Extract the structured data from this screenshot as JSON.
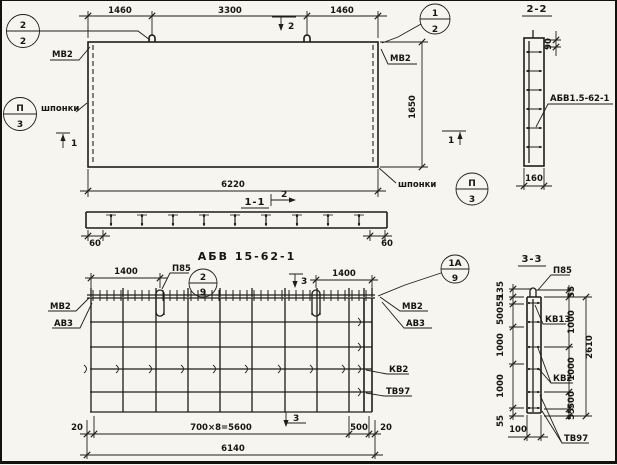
{
  "colors": {
    "ink": "#1f1d1a",
    "paper": "#f6f5f0"
  },
  "cut_marks": {
    "one": "1",
    "two": "2",
    "three": "3"
  },
  "panel_view": {
    "dims_top": [
      "1460",
      "3300",
      "1460"
    ],
    "dim_width": "6220",
    "dim_height": "1650",
    "label_mv2": "МВ2",
    "label_shponki": "шпонки",
    "callout_top_left": {
      "top": "2",
      "bottom": "2"
    },
    "callout_top_right": {
      "top": "1",
      "bottom": "2"
    },
    "callout_keys": {
      "top": "П",
      "bottom": "3"
    }
  },
  "section_1_1": {
    "title": "1-1",
    "dim_end_left": "60",
    "dim_end_right": "60"
  },
  "section_2_2": {
    "title": "2-2",
    "dim_top": "90",
    "dim_bottom": "160",
    "label_mesh": "АБВ1.5-62-1"
  },
  "mesh_view": {
    "title": "АБВ 15-62-1",
    "dim_loop_left": "1400",
    "dim_loop_right": "1400",
    "label_p85": "П85",
    "callout_left": {
      "top": "2",
      "bottom": "9"
    },
    "callout_right": {
      "top": "1А",
      "bottom": "9"
    },
    "label_mv2": "МВ2",
    "label_av3": "АВ3",
    "label_kv2": "КВ2",
    "label_tv97": "ТВ97",
    "dims_bottom": [
      "20",
      "700×8=5600",
      "500",
      "20"
    ],
    "dim_total": "6140"
  },
  "section_3_3": {
    "title": "3-3",
    "label_p85": "П85",
    "label_kv13": "КВ13",
    "label_kv2": "КВ2",
    "label_tv97": "ТВ97",
    "dims_left": [
      "135",
      "55",
      "500",
      "1000",
      "1000",
      "55"
    ],
    "dims_right": [
      "55",
      "1000",
      "1000",
      "500",
      "55"
    ],
    "dim_total": "2610",
    "dim_thickness": "100"
  }
}
